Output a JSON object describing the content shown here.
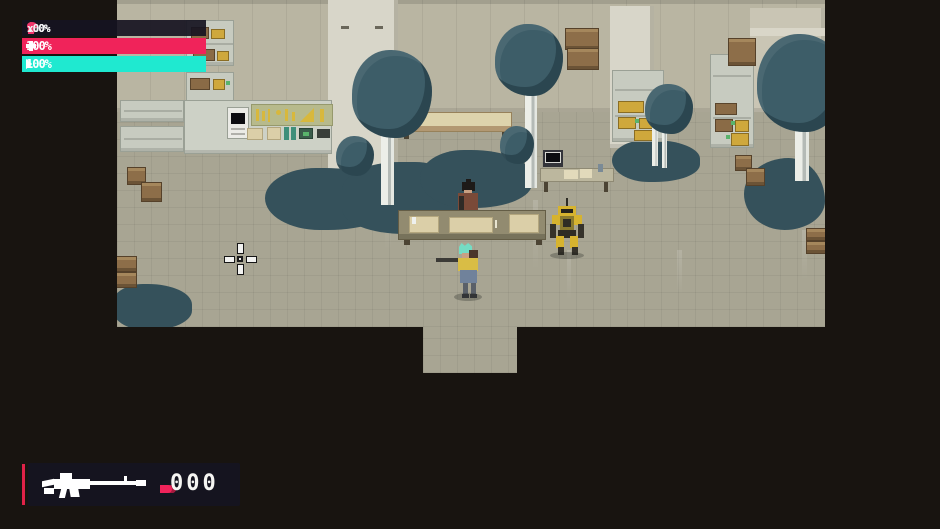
{
  "hud": {
    "stats": [
      {
        "icon": "lightning-icon",
        "value": "100%"
      },
      {
        "icon": "droplet-icon",
        "value": "100%"
      },
      {
        "icon": "figure-icon",
        "value": "100%"
      },
      {
        "icon": "tree-icon",
        "value": "x0"
      }
    ],
    "health_bar": {
      "icon": "plus-icon",
      "value": "100%",
      "color": "#f0235a"
    },
    "energy_bar": {
      "icon": "chevrons-icon",
      "value": "100%",
      "color": "#1fe9d0"
    },
    "weapon_panel": {
      "weapon_icon": "rifle-icon",
      "bullet_icon": "bullet-icon",
      "ammo": "000",
      "accent": "#f0235a"
    }
  },
  "scene": {
    "entities": {
      "player": "player-character",
      "npc": "shopkeeper-npc",
      "mech": "yellow-mech"
    },
    "palette": {
      "floor": "#a8a593",
      "wall": "#b9b5a2",
      "tree": "#3d5d68",
      "bush": "#35515b",
      "crate": "#8d6e49",
      "pillar": "#d8d6c9",
      "outer": "#181410"
    }
  }
}
